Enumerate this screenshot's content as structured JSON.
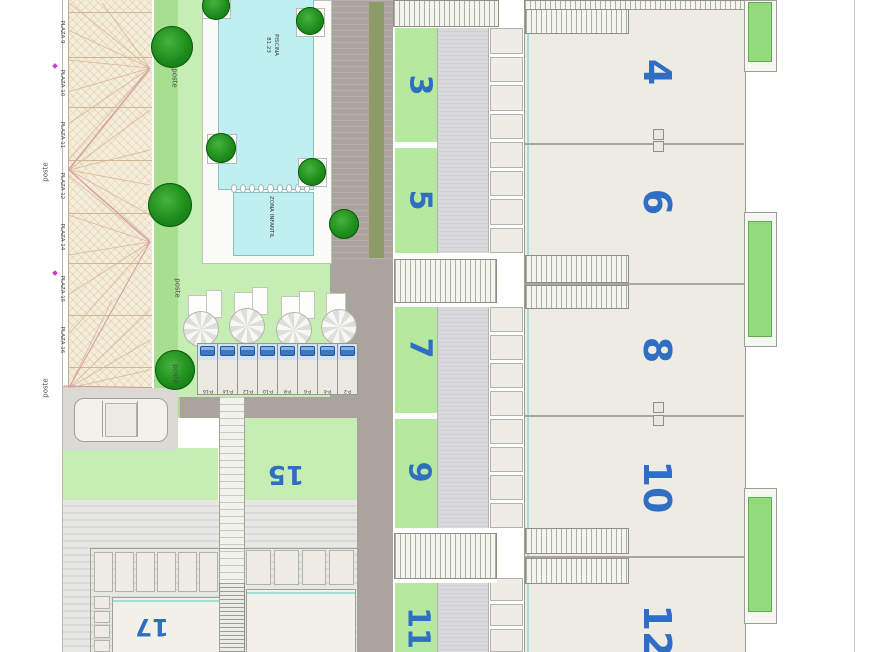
{
  "pool": {
    "name_label": "PISCINA",
    "area_label": "81.23",
    "kids_area_label": "ZONA INFANTIL"
  },
  "street_parking": {
    "plaza_labels": [
      "PLAZA 9",
      "PLAZA 10",
      "PLAZA 11",
      "PLAZA 12",
      "PLAZA 14",
      "PLAZA 15",
      "PLAZA 16"
    ]
  },
  "covered_parking": {
    "stall_labels": [
      "P-16",
      "P-14",
      "P-12",
      "P-10",
      "P-8",
      "P-6",
      "P-4",
      "P-2"
    ]
  },
  "posts": {
    "label": "poste"
  },
  "units": {
    "garden_row": [
      "3",
      "5",
      "7",
      "9",
      "11"
    ],
    "house_row": [
      "4",
      "6",
      "8",
      "10",
      "12"
    ],
    "annex": [
      "15",
      "17"
    ]
  },
  "colors": {
    "unit_number_blue": "#2f6ec2",
    "pool_water": "#bfeff0",
    "lawn_green": "#c6edb4",
    "garden_green": "#b5e9a0",
    "balcony_green": "#92da7c",
    "road_taupe": "#aba39d",
    "parking_beige": "#f4edda",
    "marker_magenta": "#d13bd1"
  }
}
